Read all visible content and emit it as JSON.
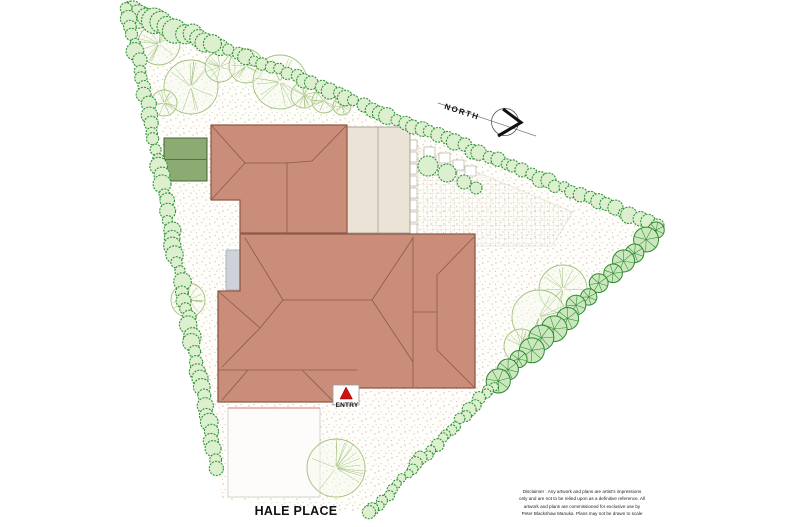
{
  "labels": {
    "north": "NORTH",
    "entry": "ENTRY",
    "street": "HALE PLACE"
  },
  "disclaimer": {
    "line1": "Disclaimer : Any artwork and plans are artist's impressions",
    "line2": "only and are not to be relied upon as a definitive reference. All",
    "line3": "artwork and plans are commissioned for exclusive use by",
    "line4": "Peter Blackshaw Manuka. Plans may not be drawn to scale"
  },
  "colors": {
    "roof": "#ca8d7a",
    "roof_line": "#8e5847",
    "annex": "#eae3d6",
    "annex_line": "#a49e8f",
    "shed": "#8cab73",
    "shed_line": "#46603b",
    "pad": "#cdd3d8",
    "pad_line": "#9aa2ab",
    "ground": "#fffefb",
    "drive_line": "#e5a3a3",
    "drive_border": "#c9c9c9",
    "tree_stroke": "#a3c17c",
    "tree_fill": "#f6faee",
    "shrub_stroke": "#2f9136",
    "shrub_fill": "#dcefcf",
    "pinwheel_stroke": "#2c8a31",
    "pinwheel_fill": "#cbe7bd",
    "stone_line": "#b7b29e",
    "entry_red": "#cc1111",
    "north_line": "#777777",
    "north_circle": "#555555",
    "north_chevron": "#111111"
  },
  "plan": {
    "boundary": [
      [
        128,
        8
      ],
      [
        656,
        226
      ],
      [
        358,
        512
      ],
      [
        222,
        500
      ]
    ],
    "paving": [
      [
        407,
        143
      ],
      [
        573,
        212
      ],
      [
        552,
        246
      ],
      [
        407,
        246
      ]
    ],
    "stepping_stones": [
      [
        406,
        140
      ],
      [
        406,
        152
      ],
      [
        406,
        164
      ],
      [
        406,
        176
      ],
      [
        406,
        188
      ],
      [
        406,
        200
      ],
      [
        406,
        212
      ],
      [
        406,
        224
      ],
      [
        424,
        147
      ],
      [
        439,
        153
      ],
      [
        453,
        160
      ],
      [
        431,
        165
      ],
      [
        446,
        171
      ],
      [
        465,
        166
      ]
    ],
    "driveway": {
      "x": 228,
      "y": 408,
      "w": 92,
      "h": 89
    },
    "buildings": {
      "shed": {
        "x": 164,
        "y": 138,
        "w": 43,
        "h": 43
      },
      "pad": {
        "x": 226,
        "y": 250,
        "w": 17,
        "h": 40
      },
      "annex": {
        "x": 347,
        "y": 127,
        "w": 63,
        "h": 106,
        "divider_x": 378
      },
      "upper_roof": [
        [
          211,
          125
        ],
        [
          347,
          125
        ],
        [
          347,
          233
        ],
        [
          240,
          233
        ],
        [
          240,
          200
        ],
        [
          211,
          200
        ]
      ],
      "upper_roof_lines": [
        [
          [
            211,
            125
          ],
          [
            245,
            163
          ]
        ],
        [
          [
            211,
            200
          ],
          [
            245,
            163
          ]
        ],
        [
          [
            245,
            163
          ],
          [
            287,
            163
          ]
        ],
        [
          [
            287,
            163
          ],
          [
            287,
            233
          ]
        ],
        [
          [
            347,
            125
          ],
          [
            312,
            161
          ]
        ],
        [
          [
            312,
            161
          ],
          [
            287,
            163
          ]
        ]
      ],
      "main_roof": [
        [
          240,
          234
        ],
        [
          475,
          234
        ],
        [
          475,
          388
        ],
        [
          357,
          388
        ],
        [
          357,
          402
        ],
        [
          218,
          402
        ],
        [
          218,
          291
        ],
        [
          240,
          291
        ]
      ],
      "main_roof_lines": [
        [
          [
            283,
            300
          ],
          [
            372,
            300
          ]
        ],
        [
          [
            283,
            300
          ],
          [
            245,
            238
          ]
        ],
        [
          [
            372,
            300
          ],
          [
            413,
            238
          ]
        ],
        [
          [
            372,
            300
          ],
          [
            413,
            362
          ]
        ],
        [
          [
            413,
            237
          ],
          [
            413,
            387
          ]
        ],
        [
          [
            437,
            275
          ],
          [
            437,
            350
          ]
        ],
        [
          [
            437,
            275
          ],
          [
            474,
            237
          ]
        ],
        [
          [
            437,
            350
          ],
          [
            474,
            387
          ]
        ],
        [
          [
            413,
            312
          ],
          [
            437,
            312
          ]
        ],
        [
          [
            218,
            291
          ],
          [
            260,
            328
          ]
        ],
        [
          [
            283,
            300
          ],
          [
            260,
            328
          ]
        ],
        [
          [
            260,
            328
          ],
          [
            222,
            367
          ]
        ],
        [
          [
            218,
            370
          ],
          [
            357,
            370
          ]
        ],
        [
          [
            222,
            400
          ],
          [
            248,
            370
          ]
        ],
        [
          [
            333,
            401
          ],
          [
            303,
            371
          ]
        ]
      ]
    },
    "trees": [
      [
        159,
        44,
        21
      ],
      [
        191,
        87,
        27
      ],
      [
        164,
        103,
        13
      ],
      [
        220,
        67,
        15
      ],
      [
        246,
        66,
        17
      ],
      [
        280,
        82,
        27
      ],
      [
        304,
        95,
        13
      ],
      [
        324,
        101,
        12
      ],
      [
        342,
        106,
        9
      ],
      [
        188,
        300,
        17
      ],
      [
        563,
        289,
        24
      ],
      [
        539,
        317,
        27
      ],
      [
        521,
        346,
        17
      ],
      [
        336,
        468,
        29
      ]
    ],
    "bushes": [
      [
        428,
        166,
        10
      ],
      [
        447,
        173,
        9
      ],
      [
        464,
        182,
        7
      ],
      [
        476,
        188,
        6
      ]
    ],
    "shrub_rows": [
      {
        "from": [
          128,
          8
        ],
        "to": [
          656,
          226
        ],
        "spacing": 9,
        "rmin": 5,
        "rmax": 8.5,
        "style": "scallop"
      },
      {
        "from": [
          131,
          12
        ],
        "to": [
          214,
          44
        ],
        "spacing": 8,
        "rmin": 8,
        "rmax": 13,
        "style": "scallop"
      },
      {
        "from": [
          128,
          8
        ],
        "to": [
          217,
          467
        ],
        "spacing": 9,
        "rmin": 5,
        "rmax": 9,
        "style": "scallop"
      },
      {
        "from": [
          658,
          230
        ],
        "to": [
          497,
          382
        ],
        "spacing": 16,
        "rmin": 8,
        "rmax": 13,
        "style": "pinwheel"
      },
      {
        "from": [
          495,
          385
        ],
        "to": [
          368,
          514
        ],
        "spacing": 7,
        "rmin": 4,
        "rmax": 7,
        "style": "scallop"
      }
    ],
    "north": {
      "circle": [
        505,
        122,
        13.5
      ],
      "line": [
        [
          438,
          103
        ],
        [
          536,
          136
        ]
      ],
      "chevron": [
        [
          503,
          109
        ],
        [
          521,
          122.5
        ],
        [
          498,
          136
        ]
      ]
    },
    "entry": {
      "box": {
        "x": 333,
        "y": 385,
        "w": 26,
        "h": 20
      },
      "triangle": [
        [
          346,
          387
        ],
        [
          340,
          399
        ],
        [
          352.5,
          399
        ]
      ]
    }
  }
}
